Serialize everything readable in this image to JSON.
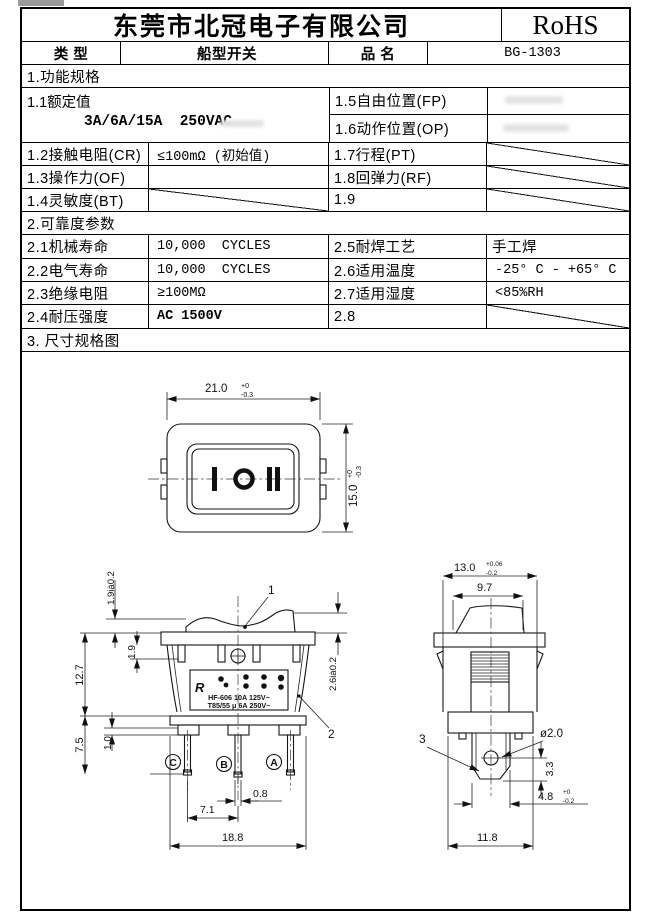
{
  "header": {
    "company": "东莞市北冠电子有限公司",
    "badge": "RoHS"
  },
  "type_row": {
    "type_label": "类 型",
    "type_value": "船型开关",
    "name_label": "品 名",
    "name_value": "BG-1303"
  },
  "sections": {
    "s1": "1.功能规格",
    "s2": "2.可靠度参数",
    "s3": "3. 尺寸规格图"
  },
  "spec1": {
    "r11_label": "1.1额定值",
    "r11_value": "3A/6A/15A  250VAC",
    "r15_label": "1.5自由位置(FP)",
    "r16_label": "1.6动作位置(OP)",
    "r12_label": "1.2接触电阻(CR)",
    "r12_value": "≤100mΩ (初始值)",
    "r17_label": "1.7行程(PT)",
    "r13_label": "1.3操作力(OF)",
    "r18_label": "1.8回弹力(RF)",
    "r14_label": "1.4灵敏度(BT)",
    "r19_label": "1.9"
  },
  "spec2": {
    "r21_label": "2.1机械寿命",
    "r21_value": "10,000  CYCLES",
    "r25_label": "2.5耐焊工艺",
    "r25_value": "手工焊",
    "r22_label": "2.2电气寿命",
    "r22_value": "10,000  CYCLES",
    "r26_label": "2.6适用温度",
    "r26_value": "-25° C - +65° C",
    "r23_label": "2.3绝缘电阻",
    "r23_value": "≥100MΩ",
    "r27_label": "2.7适用湿度",
    "r27_value": "<85%RH",
    "r24_label": "2.4耐压强度",
    "r24_value": "AC 1500V",
    "r28_label": "2.8"
  },
  "drawing": {
    "front": {
      "dim_w": "21.0",
      "dim_w_tp": "+0",
      "dim_w_tm": "-0.3",
      "dim_h": "15.0",
      "dim_h_tp": "+0",
      "dim_h_tm": "-0.3",
      "rocker_markings": "I O II"
    },
    "side": {
      "dim_top": "1.9ià0.2",
      "dim_h1": "12.7",
      "dim_h2": "7.5",
      "dim_clip": "1.9",
      "dim_base": "1.0",
      "dim_right": "2.6ià0.2",
      "dim_pin_w": "0.8",
      "dim_pitch": "7.1",
      "dim_body_w": "18.8",
      "callout1": "1",
      "callout2": "2",
      "term_c": "C",
      "term_b": "B",
      "term_a": "A",
      "logo": "R",
      "label_line1": "HF-606 10A 125V~",
      "label_line2": "T85/55 μ 6A 250V~"
    },
    "end": {
      "dim_w": "13.0",
      "dim_w_tp": "+0.06",
      "dim_w_tm": "-0.2",
      "dim_knob": "9.7",
      "dim_hole": "ø2.0",
      "callout3": "3",
      "dim_hole_v": "3.3",
      "dim_term": "4.8",
      "dim_term_tp": "+0",
      "dim_term_tm": "-0.2",
      "dim_base_w": "11.8"
    }
  }
}
